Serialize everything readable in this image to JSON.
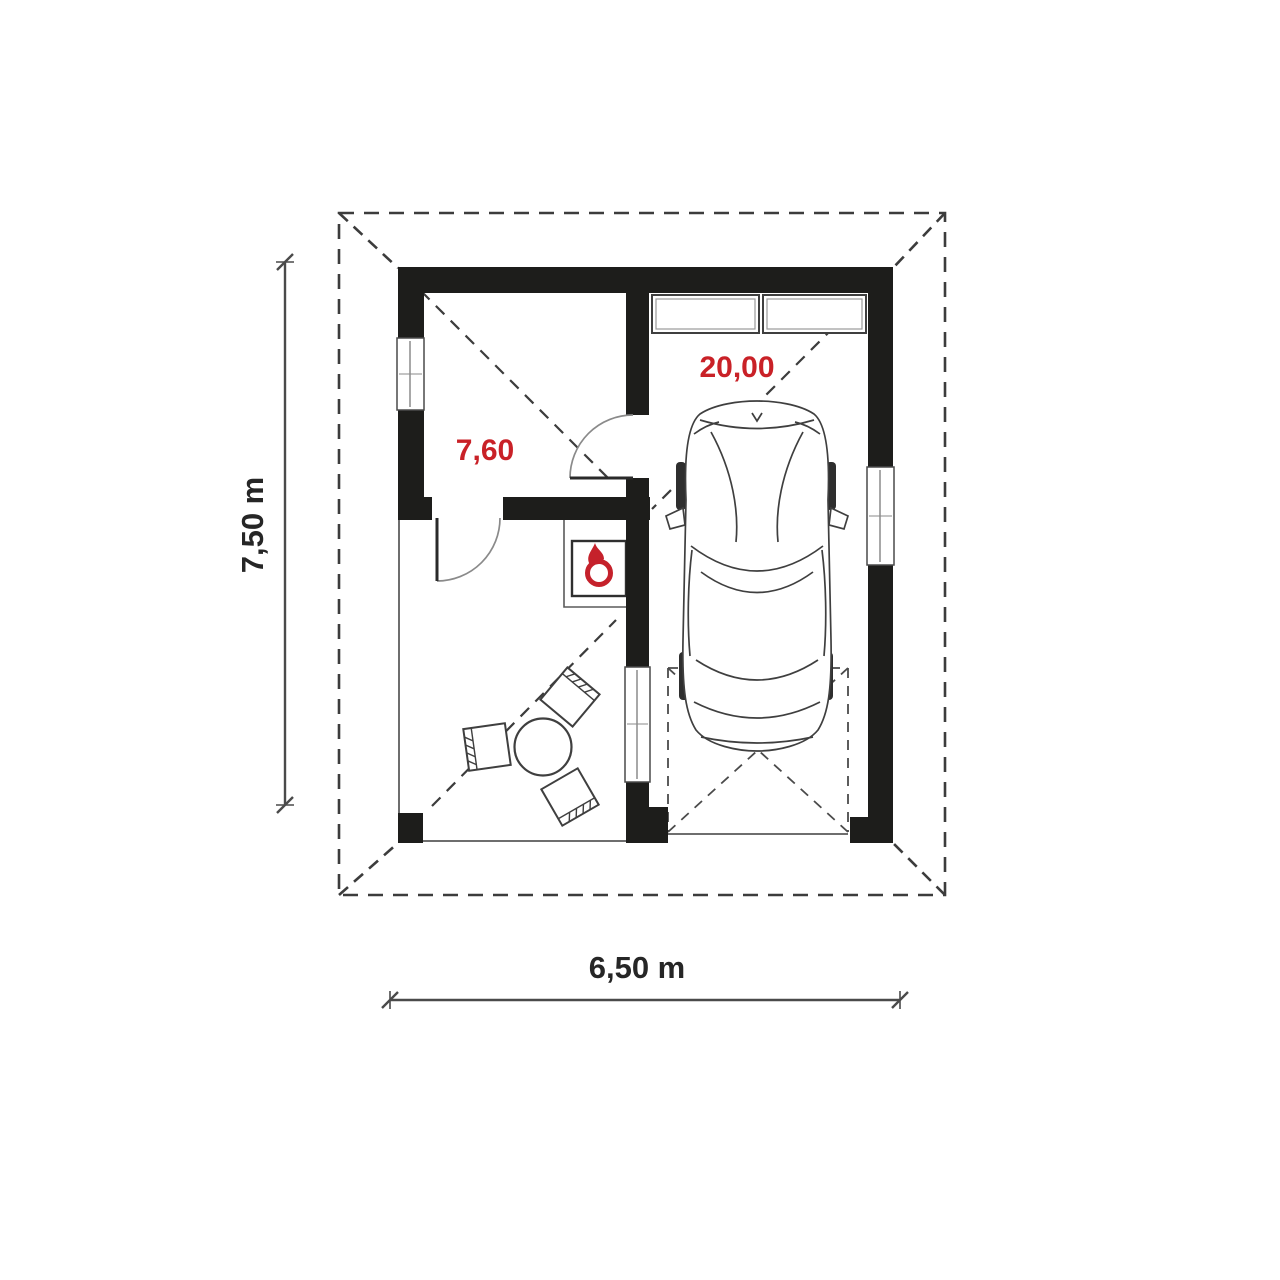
{
  "plan": {
    "room": {
      "area_label": "7,60"
    },
    "garage": {
      "area_label": "20,00"
    },
    "dimensions": {
      "vertical": "7,50 m",
      "horizontal": "6,50 m"
    },
    "icons": {
      "boiler": "flame-icon"
    },
    "colors": {
      "wall": "#1d1d1b",
      "area_label_red": "#c92127",
      "flame_red": "#c5212b",
      "linework": "#3c3c3c",
      "background": "#ffffff"
    }
  }
}
